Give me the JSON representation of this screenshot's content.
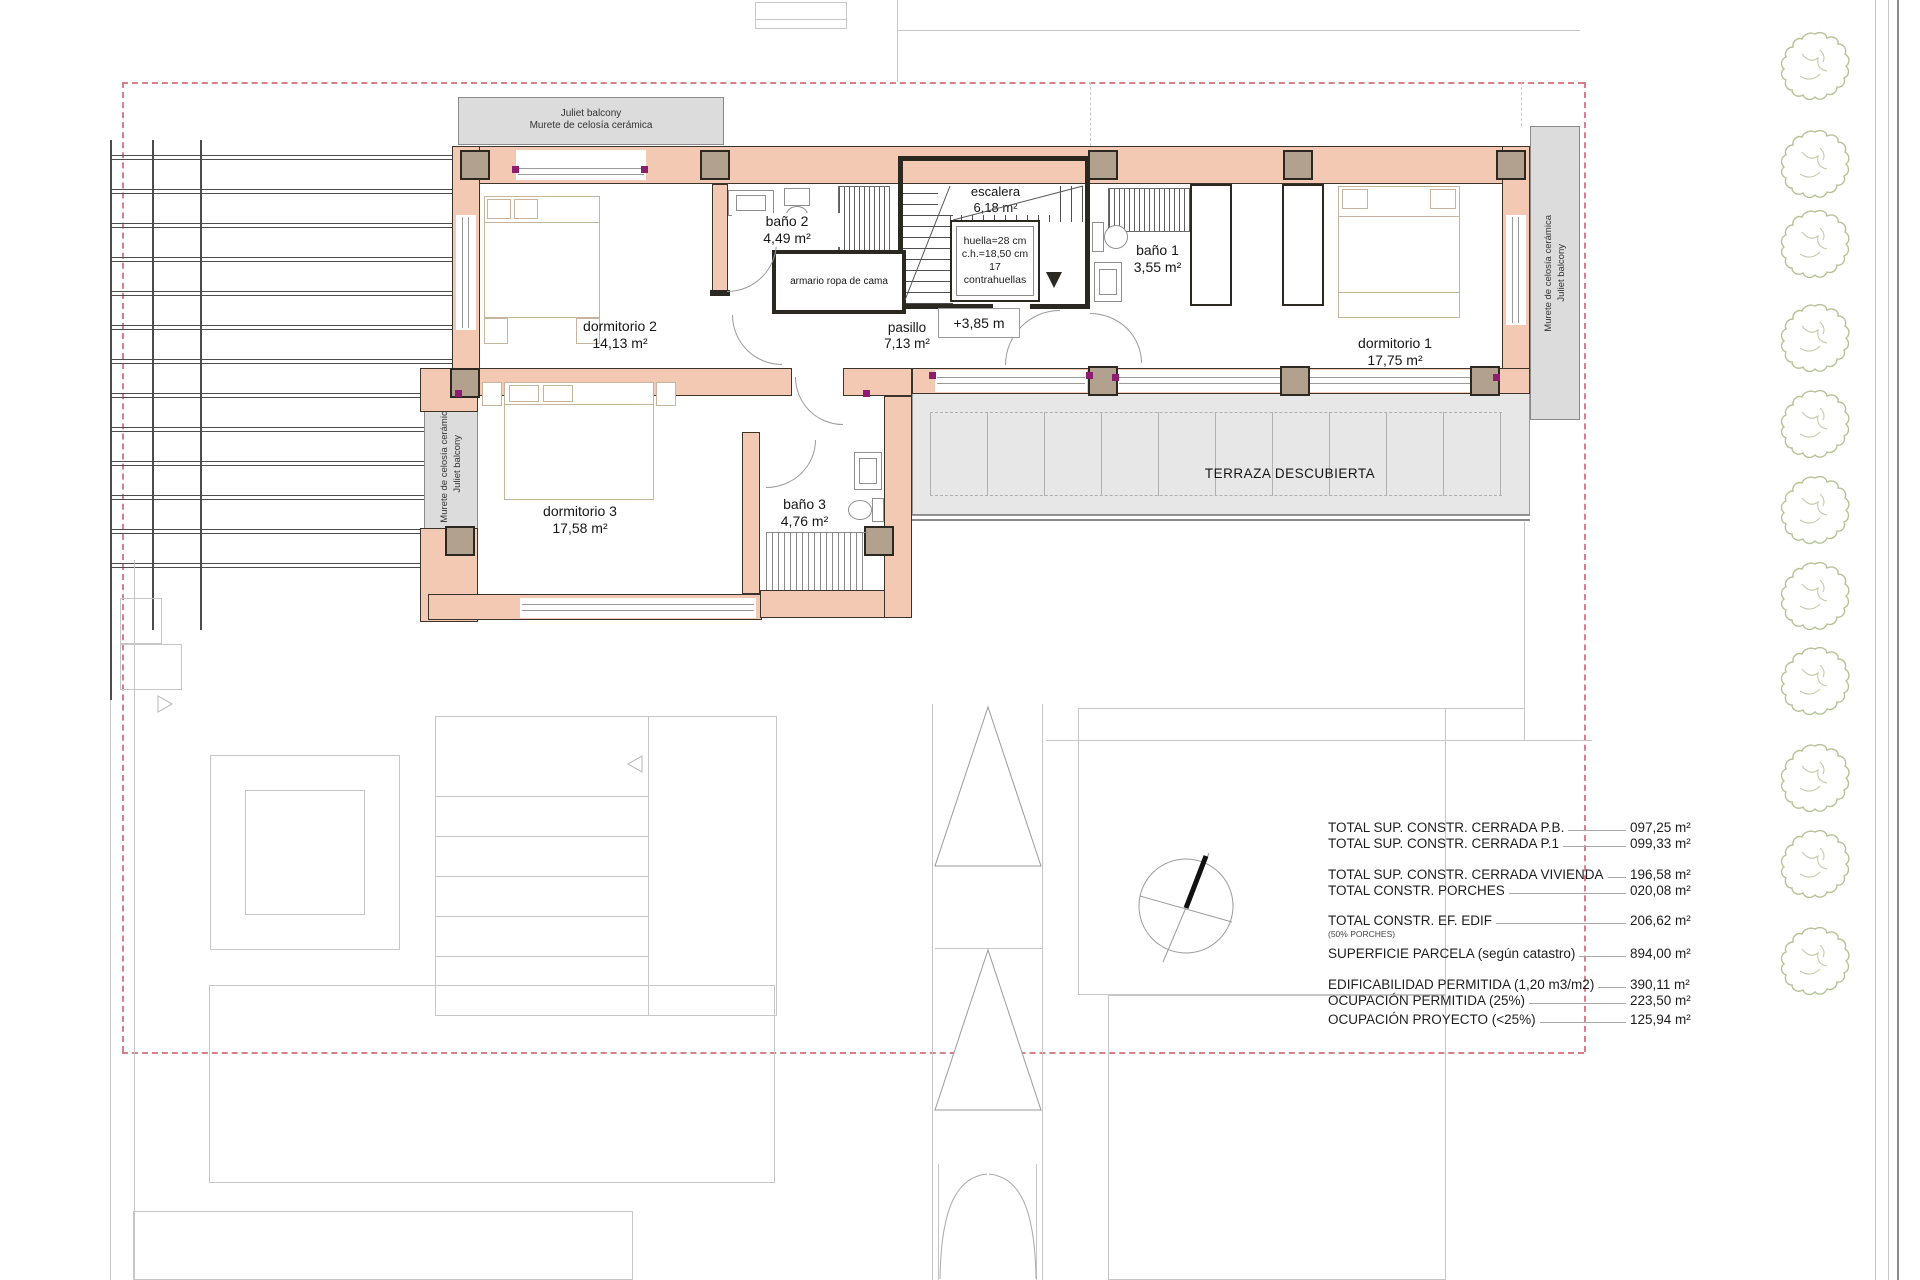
{
  "plan": {
    "balcony_top": {
      "l1": "Juliet balcony",
      "l2": "Murete de celosía cerámica"
    },
    "balcony_side": {
      "l1": "Murete de celosía cerámica",
      "l2": "Juliet balcony"
    },
    "rooms": {
      "dormitorio1": {
        "name": "dormitorio 1",
        "area": "17,75 m²"
      },
      "dormitorio2": {
        "name": "dormitorio 2",
        "area": "14,13 m²"
      },
      "dormitorio3": {
        "name": "dormitorio 3",
        "area": "17,58 m²"
      },
      "bano1": {
        "name": "baño 1",
        "area": "3,55 m²"
      },
      "bano2": {
        "name": "baño 2",
        "area": "4,49 m²"
      },
      "bano3": {
        "name": "baño 3",
        "area": "4,76 m²"
      },
      "pasillo": {
        "name": "pasillo",
        "area": "7,13 m²"
      },
      "escalera": {
        "name": "escalera",
        "area": "6,18 m²"
      }
    },
    "stair_notes": {
      "l1": "huella=28 cm",
      "l2": "c.h.=18,50 cm",
      "l3": "17 contrahuellas"
    },
    "level_marker": "+3,85 m",
    "closet_label": "armario ropa de cama",
    "terrace_label": "TERRAZA DESCUBIERTA"
  },
  "table": {
    "rows": [
      {
        "label": "TOTAL SUP. CONSTR. CERRADA P.B.",
        "value": "097,25 m²"
      },
      {
        "label": "TOTAL SUP. CONSTR. CERRADA P.1",
        "value": "099,33 m²"
      },
      {
        "label": "TOTAL SUP. CONSTR. CERRADA VIVIENDA",
        "value": "196,58 m²"
      },
      {
        "label": "TOTAL  CONSTR. PORCHES",
        "value": "020,08 m²"
      },
      {
        "label": "TOTAL  CONSTR.  EF. EDIF",
        "value": "206,62 m²",
        "sub": "(50% PORCHES)"
      },
      {
        "label": "SUPERFICIE PARCELA (según catastro)",
        "value": "894,00 m²"
      },
      {
        "label": "EDIFICABILIDAD PERMITIDA (1,20 m3/m2)",
        "value": "390,11 m²"
      },
      {
        "label": "OCUPACIÓN PERMITIDA (25%)",
        "value": "223,50 m²"
      },
      {
        "label": "OCUPACIÓN PROYECTO (<25%)",
        "value": "125,94 m²"
      }
    ]
  },
  "colors": {
    "wall": "#f4c9b4",
    "boundary": "#d5808d",
    "tree": "#b7c295",
    "column": "#b2a18f"
  }
}
